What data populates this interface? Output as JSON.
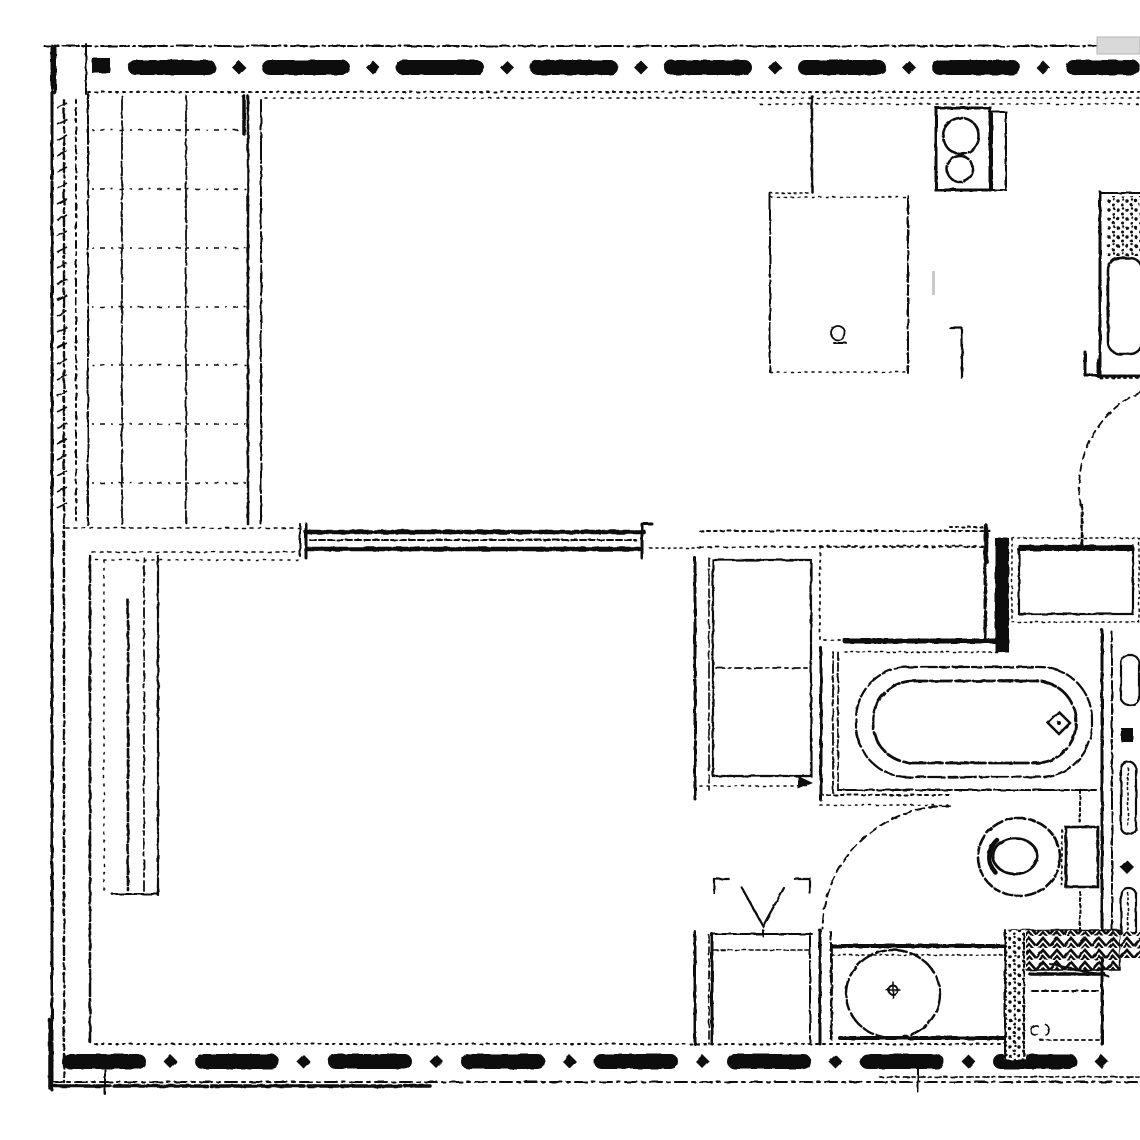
{
  "document": {
    "kind": "Scanned black-and-white architectural floor plan",
    "visible_text": "none"
  },
  "palette": {
    "ink": "#0b0b0b",
    "paper": "#ffffff",
    "artifact_gray": "#d9d9d9",
    "smudge_gray": "#c9c9c9"
  },
  "labels": {
    "floor_plan": "Apartment floor plan (scanned drawing)",
    "top_wall": "Exterior wall - top (insulated)",
    "left_wall": "Exterior wall - left",
    "bottom_wall": "Exterior wall - bottom (insulated)",
    "balcony": "Tiled balcony / loggia",
    "living_room": "Living room",
    "kitchen": "Kitchen",
    "counter": "Kitchen counter",
    "cooktop": "Cooktop with two burners",
    "kitchen_sink": "Kitchen sink unit",
    "refrigerator": "Kitchen unit / refrigerator box",
    "kitchen_table": "Kitchen furniture (dashed outline)",
    "kitchen_door": "Kitchen door swing arc",
    "hall": "Hallway",
    "wardrobe": "Built-in wardrobe with shelf",
    "vent_shaft": "Ventilation shaft symbol",
    "laundry_box": "Duct / laundry box",
    "bathroom": "Bathroom",
    "bathtub": "Bathtub",
    "tub_drain": "Bathtub drain symbol",
    "bathroom_door": "Bathroom door swing arc",
    "toilet": "Toilet bowl with cistern",
    "washbasin": "Washbasin on counter",
    "radiator": "Radiator / towel rail elements",
    "wall_hatch": "Hatched masonry wall section",
    "bath_cabinet": "Bathroom lower cabinet",
    "pier": "Interior pier / duct wall",
    "interior_wall": "Interior partition wall",
    "scan_artifact": "Scanner artifact"
  }
}
